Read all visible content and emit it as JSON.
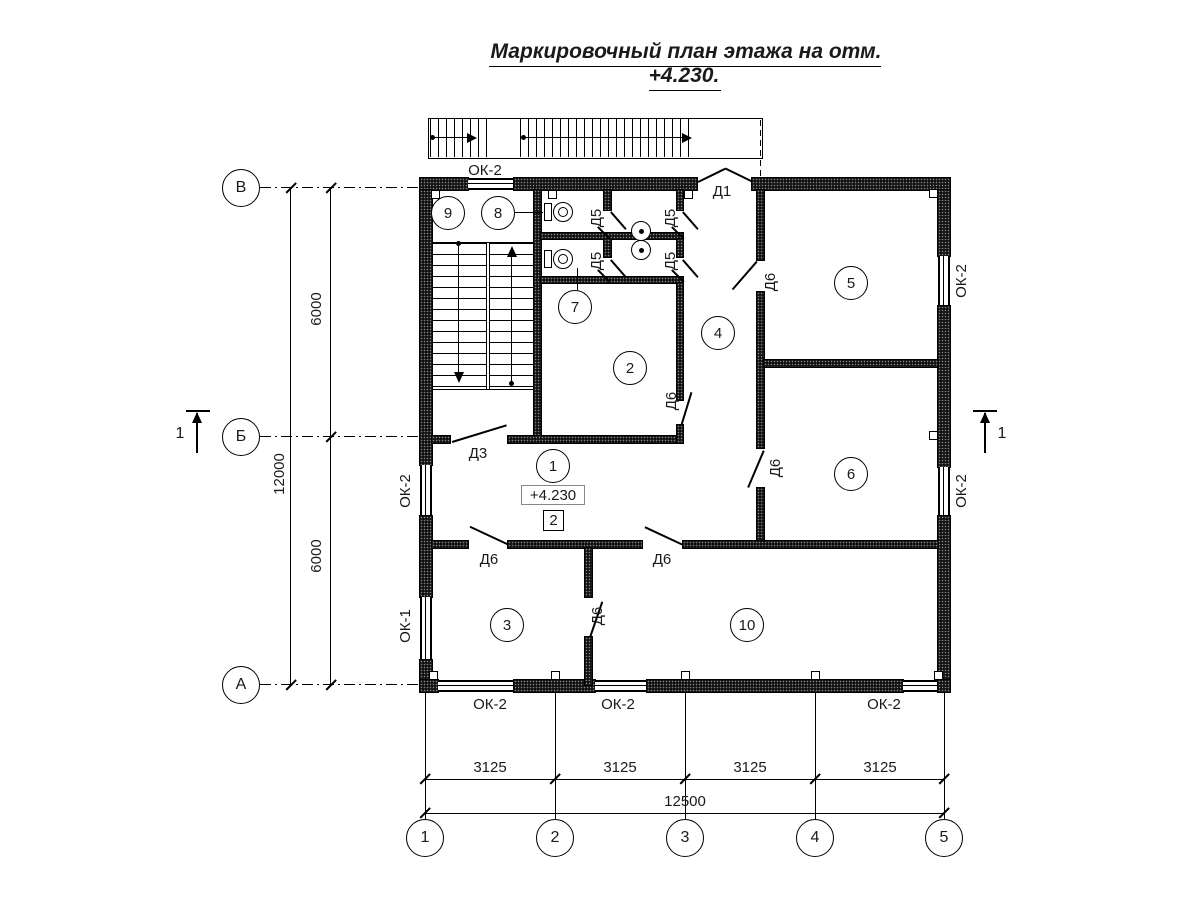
{
  "title": "Маркировочный план этажа на отм. +4.230.",
  "elevation_mark": "+4.230",
  "zone_mark": "2",
  "section_mark": "1",
  "axes": {
    "horizontal": [
      "1",
      "2",
      "3",
      "4",
      "5"
    ],
    "vertical": [
      "В",
      "Б",
      "А"
    ]
  },
  "dimensions": {
    "bottom_segments": [
      "3125",
      "3125",
      "3125",
      "3125"
    ],
    "bottom_total": "12500",
    "left_segments": [
      "6000",
      "6000"
    ],
    "left_total": "12000"
  },
  "rooms": [
    "1",
    "2",
    "3",
    "4",
    "5",
    "6",
    "7",
    "8",
    "9",
    "10"
  ],
  "labels": {
    "door_d1": "Д1",
    "door_d3": "Д3",
    "door_d5": "Д5",
    "door_d6": "Д6",
    "window_ok1": "ОК-1",
    "window_ok2": "ОК-2"
  }
}
